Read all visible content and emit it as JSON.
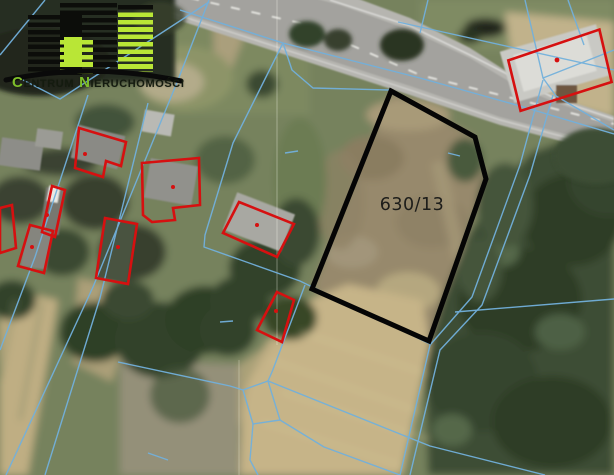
{
  "logo": {
    "word1_initial": "C",
    "word1_rest": "ENTRUM",
    "word2_initial": "N",
    "word2_rest": "IERUCHOMOŚCI",
    "initial_color": "#7fbf2a",
    "text_color": "#141b0f",
    "building_green": "#b9e636",
    "building_black": "#0c0d0a"
  },
  "map": {
    "parcel_label": "630/13",
    "parcel_outline_color": "#050505",
    "building_outline_color": "#d61010",
    "boundary_line_color": "#72b0dc",
    "label_color": "#1d1d1a"
  }
}
